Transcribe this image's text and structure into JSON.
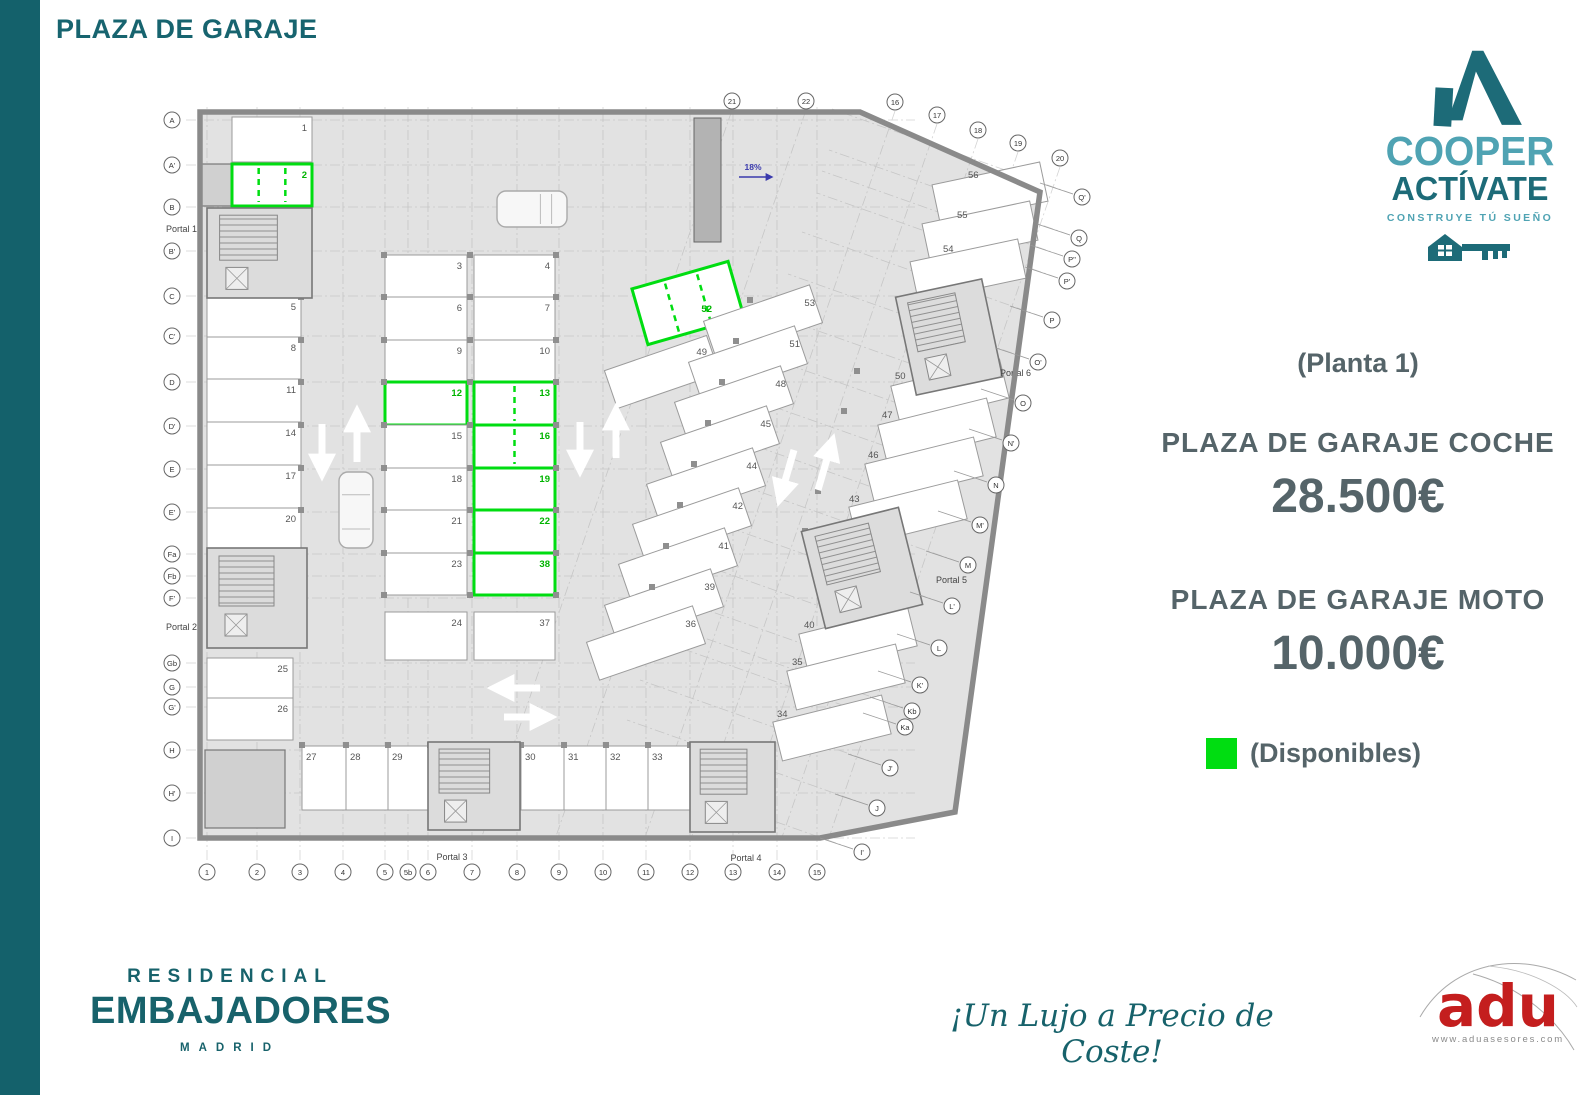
{
  "page": {
    "title": "PLAZA DE GARAJE"
  },
  "branding": {
    "name1": "COOPER",
    "name2": "ACTÍVATE",
    "tagline": "CONSTRUYE TÚ SUEÑO"
  },
  "pricing": {
    "floor": "(Planta 1)",
    "car_label": "PLAZA DE GARAJE COCHE",
    "car_price": "28.500€",
    "moto_label": "PLAZA DE GARAJE MOTO",
    "moto_price": "10.000€",
    "legend": "(Disponibles)"
  },
  "footer": {
    "brand_top": "RESIDENCIAL",
    "brand_main": "EMBAJADORES",
    "brand_city": "MADRID",
    "slogan": "¡Un Lujo a Precio de Coste!",
    "agency": "adu",
    "agency_site": "www.aduasesores.com"
  },
  "colors": {
    "teal": "#17626b",
    "light_teal": "#4fa3b3",
    "slate": "#556469",
    "green": "#00dd11",
    "green_text": "#00b400",
    "red": "#c41e1e",
    "ramp_blue": "#3a3aad"
  },
  "available_spaces": [
    "2",
    "12",
    "13",
    "16",
    "19",
    "22",
    "38",
    "52"
  ],
  "plan": {
    "ramp_label": "18%",
    "floor_outline": [
      [
        200,
        112
      ],
      [
        860,
        112
      ],
      [
        1040,
        192
      ],
      [
        955,
        812
      ],
      [
        820,
        838
      ],
      [
        200,
        838
      ]
    ],
    "spaces_rect": [
      {
        "n": "1",
        "x": 232,
        "y": 117,
        "w": 80,
        "h": 45
      },
      {
        "n": "2",
        "x": 232,
        "y": 164,
        "w": 80,
        "h": 42,
        "green": true,
        "div": 2
      },
      {
        "n": "5",
        "x": 207,
        "y": 296,
        "w": 94,
        "h": 41
      },
      {
        "n": "8",
        "x": 207,
        "y": 337,
        "w": 94,
        "h": 42
      },
      {
        "n": "11",
        "x": 207,
        "y": 379,
        "w": 94,
        "h": 43
      },
      {
        "n": "14",
        "x": 207,
        "y": 422,
        "w": 94,
        "h": 43
      },
      {
        "n": "17",
        "x": 207,
        "y": 465,
        "w": 94,
        "h": 43
      },
      {
        "n": "20",
        "x": 207,
        "y": 508,
        "w": 94,
        "h": 45
      },
      {
        "n": "25",
        "x": 207,
        "y": 658,
        "w": 86,
        "h": 40
      },
      {
        "n": "26",
        "x": 207,
        "y": 698,
        "w": 86,
        "h": 42
      },
      {
        "n": "3",
        "x": 385,
        "y": 255,
        "w": 82,
        "h": 42
      },
      {
        "n": "6",
        "x": 385,
        "y": 297,
        "w": 82,
        "h": 43
      },
      {
        "n": "9",
        "x": 385,
        "y": 340,
        "w": 82,
        "h": 42
      },
      {
        "n": "12",
        "x": 385,
        "y": 382,
        "w": 82,
        "h": 43,
        "green": true
      },
      {
        "n": "15",
        "x": 385,
        "y": 425,
        "w": 82,
        "h": 43
      },
      {
        "n": "18",
        "x": 385,
        "y": 468,
        "w": 82,
        "h": 42
      },
      {
        "n": "21",
        "x": 385,
        "y": 510,
        "w": 82,
        "h": 43
      },
      {
        "n": "23",
        "x": 385,
        "y": 553,
        "w": 82,
        "h": 42
      },
      {
        "n": "24",
        "x": 385,
        "y": 612,
        "w": 82,
        "h": 48
      },
      {
        "n": "4",
        "x": 474,
        "y": 255,
        "w": 81,
        "h": 42
      },
      {
        "n": "7",
        "x": 474,
        "y": 297,
        "w": 81,
        "h": 43
      },
      {
        "n": "10",
        "x": 474,
        "y": 340,
        "w": 81,
        "h": 42
      },
      {
        "n": "13",
        "x": 474,
        "y": 382,
        "w": 81,
        "h": 43,
        "green": true,
        "div": 1
      },
      {
        "n": "16",
        "x": 474,
        "y": 425,
        "w": 81,
        "h": 43,
        "green": true,
        "div": 1
      },
      {
        "n": "19",
        "x": 474,
        "y": 468,
        "w": 81,
        "h": 42,
        "green": true
      },
      {
        "n": "22",
        "x": 474,
        "y": 510,
        "w": 81,
        "h": 43,
        "green": true
      },
      {
        "n": "38",
        "x": 474,
        "y": 553,
        "w": 81,
        "h": 42,
        "green": true
      },
      {
        "n": "37",
        "x": 474,
        "y": 612,
        "w": 81,
        "h": 48
      },
      {
        "n": "27",
        "x": 302,
        "y": 746,
        "w": 44,
        "h": 64,
        "la": "tl"
      },
      {
        "n": "28",
        "x": 346,
        "y": 746,
        "w": 42,
        "h": 64,
        "la": "tl"
      },
      {
        "n": "29",
        "x": 388,
        "y": 746,
        "w": 42,
        "h": 64,
        "la": "tl"
      },
      {
        "n": "30",
        "x": 521,
        "y": 746,
        "w": 43,
        "h": 64,
        "la": "tl"
      },
      {
        "n": "31",
        "x": 564,
        "y": 746,
        "w": 42,
        "h": 64,
        "la": "tl"
      },
      {
        "n": "32",
        "x": 606,
        "y": 746,
        "w": 42,
        "h": 64,
        "la": "tl"
      },
      {
        "n": "33",
        "x": 648,
        "y": 746,
        "w": 42,
        "h": 64,
        "la": "tl"
      }
    ],
    "spaces_rot": [
      {
        "n": "52",
        "cx": 688,
        "cy": 303,
        "w": 100,
        "h": 58,
        "rot": -16,
        "green": true,
        "div": 2,
        "l": [
          712,
          312
        ],
        "ta": "e"
      },
      {
        "n": "49",
        "cx": 662,
        "cy": 372,
        "w": 108,
        "h": 40,
        "rot": -19,
        "l": [
          707,
          355
        ],
        "ta": "e"
      },
      {
        "n": "53",
        "cx": 763,
        "cy": 322,
        "w": 112,
        "h": 40,
        "rot": -19,
        "l": [
          815,
          306
        ],
        "ta": "e"
      },
      {
        "n": "51",
        "cx": 748,
        "cy": 363,
        "w": 112,
        "h": 40,
        "rot": -19,
        "l": [
          800,
          347
        ],
        "ta": "e"
      },
      {
        "n": "48",
        "cx": 734,
        "cy": 403,
        "w": 112,
        "h": 40,
        "rot": -19,
        "l": [
          786,
          387
        ],
        "ta": "e"
      },
      {
        "n": "45",
        "cx": 720,
        "cy": 443,
        "w": 112,
        "h": 40,
        "rot": -19,
        "l": [
          771,
          427
        ],
        "ta": "e"
      },
      {
        "n": "44",
        "cx": 706,
        "cy": 485,
        "w": 112,
        "h": 40,
        "rot": -19,
        "l": [
          757,
          469
        ],
        "ta": "e"
      },
      {
        "n": "42",
        "cx": 692,
        "cy": 525,
        "w": 112,
        "h": 40,
        "rot": -19,
        "l": [
          743,
          509
        ],
        "ta": "e"
      },
      {
        "n": "41",
        "cx": 678,
        "cy": 565,
        "w": 112,
        "h": 40,
        "rot": -19,
        "l": [
          729,
          549
        ],
        "ta": "e"
      },
      {
        "n": "39",
        "cx": 664,
        "cy": 606,
        "w": 112,
        "h": 40,
        "rot": -19,
        "l": [
          715,
          590
        ],
        "ta": "e"
      },
      {
        "n": "36",
        "cx": 646,
        "cy": 643,
        "w": 112,
        "h": 40,
        "rot": -19,
        "l": [
          696,
          627
        ],
        "ta": "e"
      },
      {
        "n": "56",
        "cx": 990,
        "cy": 193,
        "w": 110,
        "h": 40,
        "rot": -12,
        "l": [
          968,
          178
        ],
        "ta": "s"
      },
      {
        "n": "55",
        "cx": 980,
        "cy": 232,
        "w": 110,
        "h": 40,
        "rot": -12,
        "l": [
          957,
          218
        ],
        "ta": "s"
      },
      {
        "n": "54",
        "cx": 968,
        "cy": 270,
        "w": 110,
        "h": 40,
        "rot": -12,
        "l": [
          943,
          252
        ],
        "ta": "s"
      },
      {
        "n": "50",
        "cx": 950,
        "cy": 392,
        "w": 112,
        "h": 40,
        "rot": -14,
        "l": [
          895,
          379
        ],
        "ta": "s"
      },
      {
        "n": "47",
        "cx": 937,
        "cy": 431,
        "w": 112,
        "h": 40,
        "rot": -14,
        "l": [
          882,
          418
        ],
        "ta": "s"
      },
      {
        "n": "46",
        "cx": 924,
        "cy": 470,
        "w": 112,
        "h": 40,
        "rot": -14,
        "l": [
          868,
          458
        ],
        "ta": "s"
      },
      {
        "n": "43",
        "cx": 908,
        "cy": 513,
        "w": 112,
        "h": 40,
        "rot": -14,
        "l": [
          849,
          502
        ],
        "ta": "s"
      },
      {
        "n": "40",
        "cx": 858,
        "cy": 640,
        "w": 112,
        "h": 40,
        "rot": -14,
        "l": [
          804,
          628
        ],
        "ta": "s"
      },
      {
        "n": "35",
        "cx": 846,
        "cy": 677,
        "w": 112,
        "h": 40,
        "rot": -14,
        "l": [
          792,
          665
        ],
        "ta": "s"
      },
      {
        "n": "34",
        "cx": 832,
        "cy": 728,
        "w": 112,
        "h": 40,
        "rot": -14,
        "l": [
          777,
          717
        ],
        "ta": "s"
      }
    ],
    "portals": [
      {
        "name": "Portal 1",
        "block": [
          207,
          208,
          105,
          90
        ],
        "l": [
          197,
          232
        ],
        "ta": "e"
      },
      {
        "name": "Portal 2",
        "block": [
          207,
          548,
          100,
          100
        ],
        "l": [
          197,
          630
        ],
        "ta": "e"
      },
      {
        "name": "Portal 3",
        "block": [
          428,
          742,
          92,
          88
        ],
        "l": [
          452,
          860
        ],
        "ta": "m"
      },
      {
        "name": "Portal 4",
        "block": [
          690,
          742,
          85,
          90
        ],
        "l": [
          746,
          861
        ],
        "ta": "m"
      },
      {
        "name": "Portal 5",
        "block": [
          812,
          518,
          100,
          100
        ],
        "rot": -14,
        "l": [
          936,
          583
        ],
        "ta": "s"
      },
      {
        "name": "Portal 6",
        "block": [
          905,
          287,
          88,
          100
        ],
        "rot": -12,
        "l": [
          1000,
          376
        ],
        "ta": "s"
      }
    ],
    "rooms": [
      {
        "x": 205,
        "y": 750,
        "w": 80,
        "h": 78
      },
      {
        "x": 200,
        "y": 164,
        "w": 32,
        "h": 42
      }
    ],
    "axes": {
      "left": [
        {
          "l": "A",
          "y": 120
        },
        {
          "l": "A'",
          "y": 165
        },
        {
          "l": "B",
          "y": 207
        },
        {
          "l": "B'",
          "y": 251
        },
        {
          "l": "C",
          "y": 296
        },
        {
          "l": "C'",
          "y": 336
        },
        {
          "l": "D",
          "y": 382
        },
        {
          "l": "D'",
          "y": 426
        },
        {
          "l": "E",
          "y": 469
        },
        {
          "l": "E'",
          "y": 512
        },
        {
          "l": "Fa",
          "y": 554
        },
        {
          "l": "Fb",
          "y": 576
        },
        {
          "l": "F'",
          "y": 598
        },
        {
          "l": "Gb",
          "y": 663
        },
        {
          "l": "G",
          "y": 687
        },
        {
          "l": "G'",
          "y": 707
        },
        {
          "l": "H",
          "y": 750
        },
        {
          "l": "H'",
          "y": 793
        },
        {
          "l": "I",
          "y": 838
        }
      ],
      "bottom": [
        {
          "l": "1",
          "x": 207
        },
        {
          "l": "2",
          "x": 257
        },
        {
          "l": "3",
          "x": 300
        },
        {
          "l": "4",
          "x": 343
        },
        {
          "l": "5",
          "x": 385
        },
        {
          "l": "5b",
          "x": 408
        },
        {
          "l": "6",
          "x": 428
        },
        {
          "l": "7",
          "x": 472
        },
        {
          "l": "8",
          "x": 517
        },
        {
          "l": "9",
          "x": 559
        },
        {
          "l": "10",
          "x": 603
        },
        {
          "l": "11",
          "x": 646
        },
        {
          "l": "12",
          "x": 690
        },
        {
          "l": "13",
          "x": 733
        },
        {
          "l": "14",
          "x": 777
        },
        {
          "l": "15",
          "x": 817
        }
      ],
      "top": [
        {
          "l": "21",
          "x": 732,
          "y": 101
        },
        {
          "l": "22",
          "x": 806,
          "y": 101
        },
        {
          "l": "16",
          "x": 895,
          "y": 102
        },
        {
          "l": "17",
          "x": 937,
          "y": 115
        },
        {
          "l": "18",
          "x": 978,
          "y": 130
        },
        {
          "l": "19",
          "x": 1018,
          "y": 143
        },
        {
          "l": "20",
          "x": 1060,
          "y": 158
        }
      ],
      "right": [
        {
          "l": "Q'",
          "x": 1082,
          "y": 197
        },
        {
          "l": "Q",
          "x": 1079,
          "y": 238
        },
        {
          "l": "P''",
          "x": 1072,
          "y": 259
        },
        {
          "l": "P'",
          "x": 1067,
          "y": 281
        },
        {
          "l": "P",
          "x": 1052,
          "y": 320
        },
        {
          "l": "O'",
          "x": 1038,
          "y": 362
        },
        {
          "l": "O",
          "x": 1023,
          "y": 403
        },
        {
          "l": "N'",
          "x": 1011,
          "y": 443
        },
        {
          "l": "N",
          "x": 996,
          "y": 485
        },
        {
          "l": "M'",
          "x": 980,
          "y": 525
        },
        {
          "l": "M",
          "x": 968,
          "y": 565
        },
        {
          "l": "L'",
          "x": 952,
          "y": 606
        },
        {
          "l": "L",
          "x": 939,
          "y": 648
        },
        {
          "l": "K'",
          "x": 920,
          "y": 685
        },
        {
          "l": "Kb",
          "x": 912,
          "y": 711
        },
        {
          "l": "Ka",
          "x": 905,
          "y": 727
        },
        {
          "l": "J'",
          "x": 890,
          "y": 768
        },
        {
          "l": "J",
          "x": 877,
          "y": 808
        },
        {
          "l": "I'",
          "x": 862,
          "y": 852
        }
      ]
    },
    "arrows": [
      {
        "x1": 322,
        "y1": 424,
        "x2": 322,
        "y2": 462
      },
      {
        "x1": 357,
        "y1": 462,
        "x2": 357,
        "y2": 424
      },
      {
        "x1": 580,
        "y1": 422,
        "x2": 580,
        "y2": 458
      },
      {
        "x1": 616,
        "y1": 458,
        "x2": 616,
        "y2": 422
      },
      {
        "x1": 794,
        "y1": 450,
        "x2": 783,
        "y2": 488
      },
      {
        "x1": 818,
        "y1": 490,
        "x2": 829,
        "y2": 452
      },
      {
        "x1": 540,
        "y1": 688,
        "x2": 506,
        "y2": 688
      },
      {
        "x1": 504,
        "y1": 717,
        "x2": 538,
        "y2": 717
      }
    ],
    "cars": [
      {
        "x": 497,
        "y": 191,
        "w": 70,
        "h": 36,
        "dir": "h"
      },
      {
        "x": 339,
        "y": 472,
        "w": 34,
        "h": 76,
        "dir": "v"
      }
    ],
    "ramp": {
      "x": 694,
      "y": 118,
      "w": 27,
      "h": 124,
      "ax1": 739,
      "ay": 177,
      "ax2": 768,
      "tx": 753,
      "ty": 170
    }
  }
}
